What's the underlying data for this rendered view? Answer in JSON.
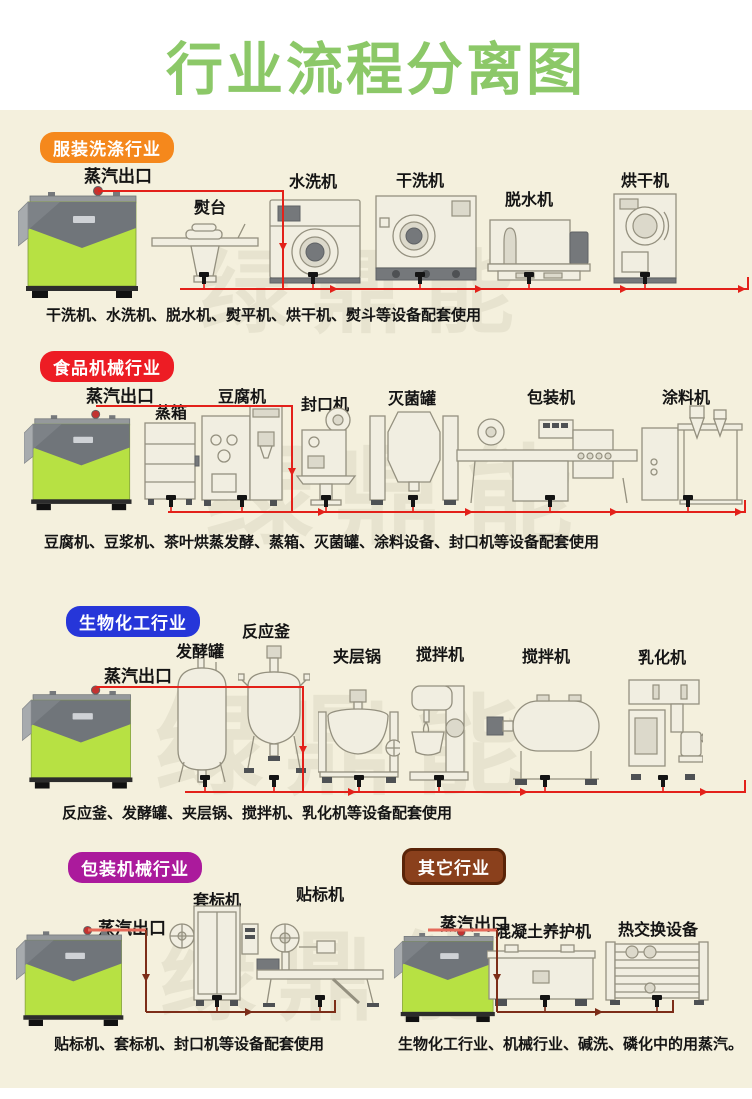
{
  "page": {
    "title": "行业流程分离图",
    "watermark": "绿鼎能"
  },
  "colors": {
    "title_green": "#8cc868",
    "background_cream": "#f4f0dd",
    "pipe_red": "#e3211a",
    "pipe_dark_brown": "#7c2d18",
    "pipe_feed_salmon": "#e56a5a",
    "boiler_green": "#b7e143",
    "boiler_gray": "#70757a"
  },
  "sections": [
    {
      "badge": "服装洗涤行业",
      "badge_color": "#f5881c",
      "steam_outlet": "蒸汽出口",
      "machines": [
        "熨台",
        "水洗机",
        "干洗机",
        "脱水机",
        "烘干机"
      ],
      "caption": "干洗机、水洗机、脱水机、熨平机、烘干机、熨斗等设备配套使用"
    },
    {
      "badge": "食品机械行业",
      "badge_color": "#ed1c24",
      "steam_outlet": "蒸汽出口",
      "machines": [
        "蒸箱",
        "豆腐机",
        "封口机",
        "灭菌罐",
        "包装机",
        "涂料机"
      ],
      "caption": "豆腐机、豆浆机、茶叶烘蒸发酵、蒸箱、灭菌罐、涂料设备、封口机等设备配套使用"
    },
    {
      "badge": "生物化工行业",
      "badge_color": "#2636d9",
      "steam_outlet": "蒸汽出口",
      "machines": [
        "发酵罐",
        "反应釜",
        "夹层锅",
        "搅拌机",
        "搅拌机",
        "乳化机"
      ],
      "caption": "反应釜、发酵罐、夹层锅、搅拌机、乳化机等设备配套使用"
    },
    {
      "badge": "包装机械行业",
      "badge_color": "#ab1a9c",
      "steam_outlet": "蒸汽出口",
      "machines": [
        "套标机",
        "贴标机"
      ],
      "caption": "贴标机、套标机、封口机等设备配套使用"
    },
    {
      "badge": "其它行业",
      "badge_color": "#8a401c",
      "badge_border": "#5a2408",
      "steam_outlet": "蒸汽出口",
      "machines": [
        "混凝土养护机",
        "热交换设备"
      ],
      "caption": "生物化工行业、机械行业、碱洗、磷化中的用蒸汽。"
    }
  ]
}
